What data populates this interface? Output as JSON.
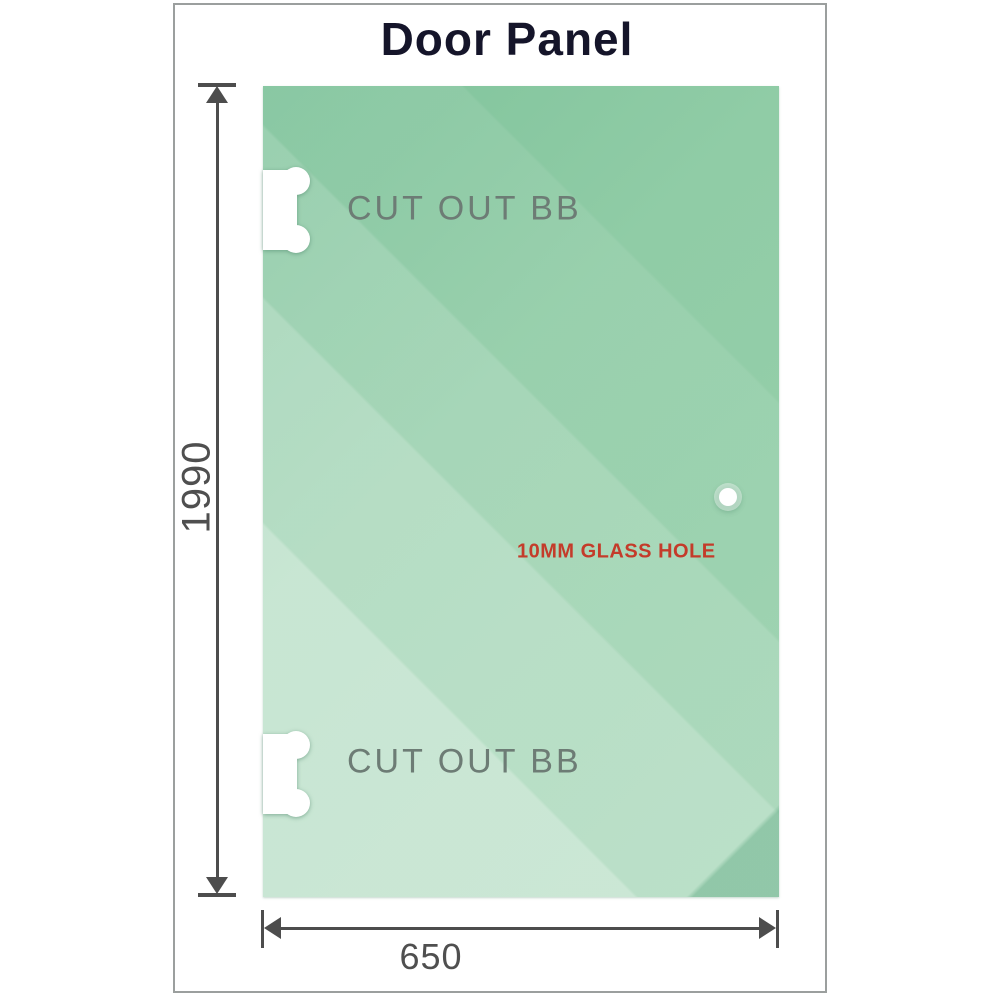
{
  "title": "Door Panel",
  "panel": {
    "top_cutout_label": "CUT OUT BB",
    "bottom_cutout_label": "CUT OUT BB",
    "hole_label": "10MM GLASS HOLE"
  },
  "dimensions": {
    "height": "1990",
    "width": "650"
  },
  "colors": {
    "glass_base": "#8fcba5",
    "glass_light_band": "#c9e9d2",
    "dimension_line": "#4d4d4d",
    "hole_label_color": "#c43b2a",
    "cutout_label_color": "#6d7c75",
    "title_color": "#15152a",
    "frame_border": "#9b9f9e"
  }
}
